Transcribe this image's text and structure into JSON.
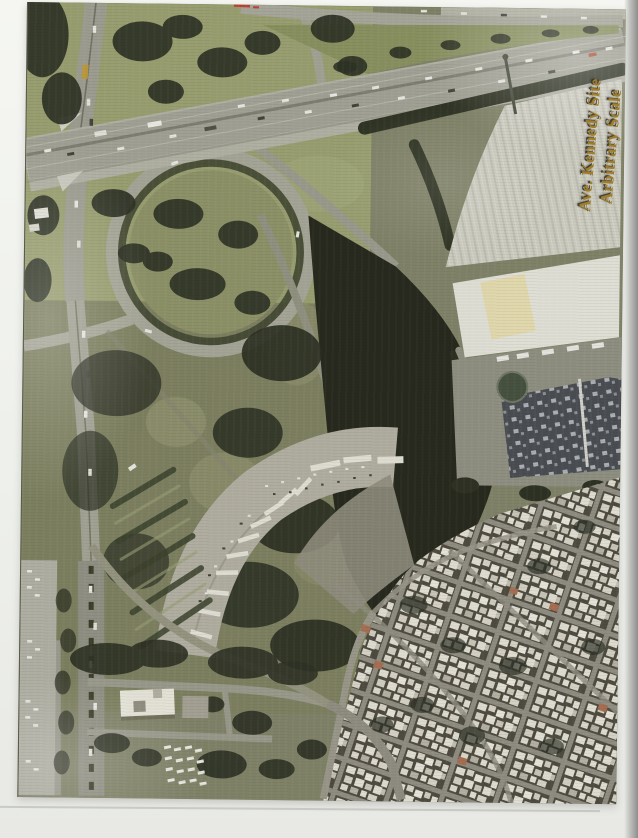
{
  "page": {
    "kind": "scanned aerial photograph page",
    "background_color": "#eef0ec",
    "edge_shadow_color": "#8d8e8c"
  },
  "photo": {
    "kind": "aerial-photograph",
    "annotation": {
      "line1": "Ave. Kennedy Site",
      "line2": "Arbitrary Scale",
      "text_color": "#a07d2a"
    },
    "palette": {
      "parkland_green": "#99a06e",
      "scrub_field": "#7b7e5c",
      "dark_vacant_site": "#1c1e13",
      "highway_pavement": "#a2a296",
      "warehouse_roof": "#d2d2c7",
      "dark_warehouse_roof": "#42464c",
      "residential_ground": "#474339",
      "house_roof_white": "#e7e5da",
      "tree_canopy": "#23271a",
      "yellow_bus": "#c09a33",
      "red_scan_mark": "#c03a2c"
    }
  }
}
